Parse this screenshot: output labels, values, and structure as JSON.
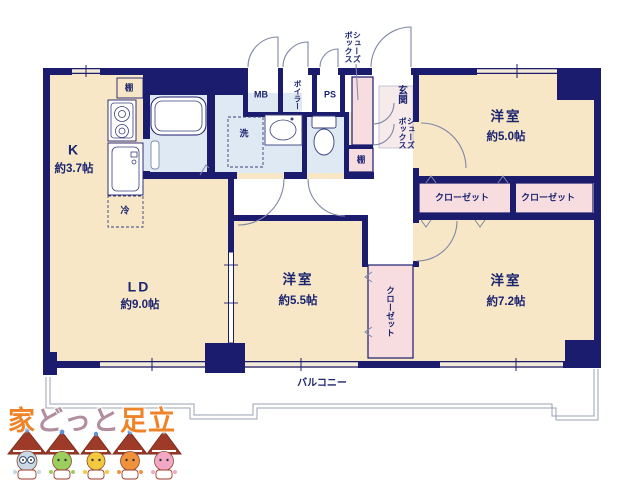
{
  "plan_type": "floor-plan",
  "colors": {
    "wall_navy": "#1c1c6e",
    "room_beige": "#f7e7c6",
    "wet_blue": "#dfe9f3",
    "storage_pink": "#f7dce0",
    "genkan_pink": "#f7eaea",
    "thin_line": "#8087a8",
    "balcony_line": "#9aa2b2",
    "text_navy": "#1b2470",
    "logo_orange": "#f08228",
    "logo_mauve": "#b18d9e",
    "mascot_roof": "#9e3a28",
    "mascot_faces": [
      "#c8d8e4",
      "#9cce5e",
      "#f3c93e",
      "#f0913c",
      "#f2a8c4"
    ]
  },
  "rooms": {
    "kitchen": {
      "label": "K",
      "area": "約3.7帖"
    },
    "living_dining": {
      "label": "LD",
      "area": "約9.0帖"
    },
    "bedroom_center": {
      "label": "洋室",
      "area": "約5.5帖"
    },
    "bedroom_ne": {
      "label": "洋室",
      "area": "約5.0帖"
    },
    "bedroom_se": {
      "label": "洋室",
      "area": "約7.2帖"
    }
  },
  "labels": {
    "balcony": "バルコニー",
    "entrance": "玄関",
    "shoes_box": "シューズボックス",
    "closet": "クローゼット",
    "shelf": "棚",
    "fridge": "冷",
    "washer": "洗",
    "meter_box": "MB",
    "boiler": "ボイラー",
    "pipe_space": "PS"
  },
  "logo": {
    "part_house": "家",
    "part_dot": "どっと",
    "part_adachi": "足立",
    "mascot_count": 5
  }
}
